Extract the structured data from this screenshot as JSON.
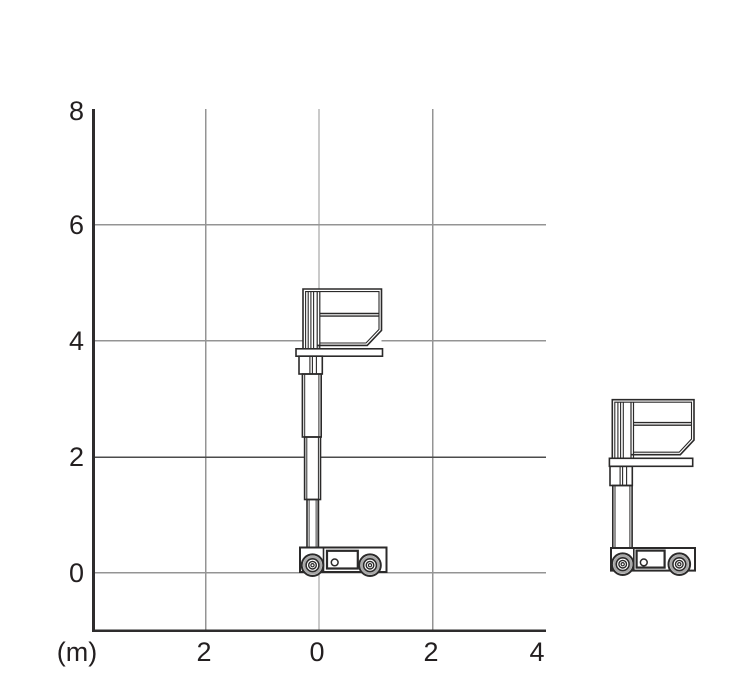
{
  "figure": {
    "kind": "mast-lift-working-range-diagram",
    "unit_label": "(m)",
    "y_axis": {
      "ticks": [
        "8",
        "6",
        "4",
        "2",
        "0"
      ]
    },
    "x_axis": {
      "ticks": [
        "2",
        "0",
        "2",
        "4"
      ]
    }
  },
  "drawings": {
    "extended_lift": "vertical-mast-lift-elevated",
    "stowed_lift": "vertical-mast-lift-stowed"
  },
  "colors": {
    "ink": "#2b2a2a",
    "grid": "#949494",
    "grid_emphasis_2m": "#4b4b4b",
    "text": "#231f20",
    "background": "#ffffff"
  },
  "chart_data": {
    "type": "diagram",
    "title": "",
    "unit": "(m)",
    "grid": true,
    "x_axis": {
      "tick_labels": [
        "2",
        "0",
        "2",
        "4"
      ],
      "range_m": [
        -4,
        4
      ],
      "gridlines_at_m": [
        -2,
        0,
        2
      ]
    },
    "y_axis": {
      "tick_labels": [
        "8",
        "6",
        "4",
        "2",
        "0"
      ],
      "range_m": [
        -1,
        8
      ],
      "gridlines_at_m": [
        0,
        2,
        4,
        6
      ]
    },
    "figures": [
      {
        "name": "mast-lift-elevated",
        "location": "inside-plot",
        "mast_centered_at_x_m": 0,
        "platform_floor_height_m": 3.9,
        "platform_rail_top_height_m": 4.9
      },
      {
        "name": "mast-lift-stowed",
        "location": "outside-plot-right"
      }
    ]
  }
}
